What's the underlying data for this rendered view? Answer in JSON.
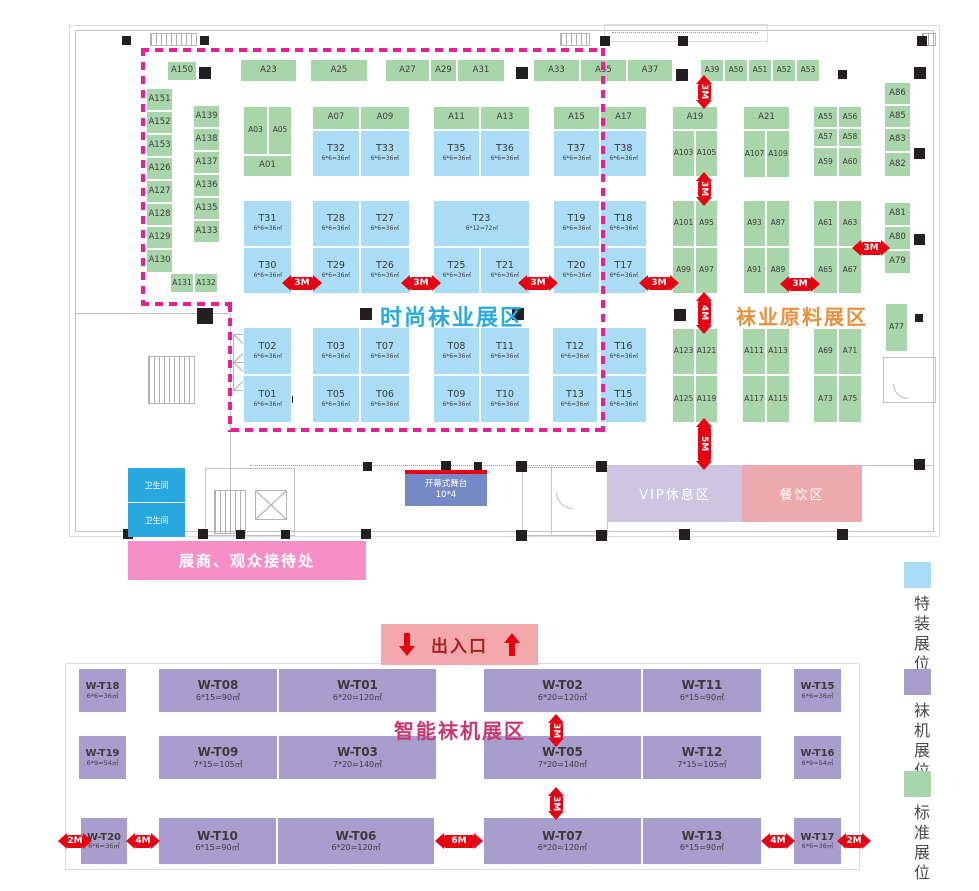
{
  "titles": {
    "fashion": {
      "label": "时尚袜业展区",
      "color": "#29abe2"
    },
    "material": {
      "label": "袜业原料展区",
      "color": "#e8913c"
    },
    "machine": {
      "label": "智能袜机展区",
      "color": "#c9386e"
    }
  },
  "legend": {
    "special": {
      "label": "特装展位",
      "color": "#aadcf5"
    },
    "machine": {
      "label": "袜机展位",
      "color": "#a79ecd"
    },
    "standard": {
      "label": "标准展位",
      "color": "#a8d6aa"
    }
  },
  "facilities": {
    "entrance": {
      "label": "出入口"
    },
    "stage": {
      "label": "开幕式舞台",
      "size": "10*4"
    },
    "vip": {
      "label": "VIP休息区"
    },
    "dining": {
      "label": "餐饮区"
    },
    "reception": {
      "label": "展商、观众接待处"
    },
    "restroom": {
      "label": "卫生间"
    }
  },
  "booths": {
    "standard": [
      [
        "A150",
        167,
        61,
        30,
        20
      ],
      [
        "A151",
        146,
        88,
        27,
        23
      ],
      [
        "A152",
        146,
        111,
        27,
        23
      ],
      [
        "A153",
        146,
        134,
        27,
        23
      ],
      [
        "A126",
        146,
        157,
        27,
        23
      ],
      [
        "A127",
        146,
        180,
        27,
        23
      ],
      [
        "A128",
        146,
        203,
        27,
        23
      ],
      [
        "A129",
        146,
        226,
        27,
        23
      ],
      [
        "A130",
        146,
        249,
        27,
        24
      ],
      [
        "A139",
        193,
        105,
        27,
        23
      ],
      [
        "A138",
        193,
        128,
        27,
        23
      ],
      [
        "A137",
        193,
        151,
        27,
        23
      ],
      [
        "A136",
        193,
        174,
        27,
        23
      ],
      [
        "A135",
        193,
        197,
        27,
        23
      ],
      [
        "A133",
        193,
        220,
        27,
        23
      ],
      [
        "A131",
        170,
        273,
        24,
        20
      ],
      [
        "A132",
        194,
        273,
        24,
        20
      ],
      [
        "A23",
        240,
        59,
        57,
        23
      ],
      [
        "A25",
        310,
        59,
        58,
        23
      ],
      [
        "A27",
        385,
        59,
        45,
        23
      ],
      [
        "A29",
        430,
        59,
        27,
        23
      ],
      [
        "A31",
        457,
        59,
        48,
        23
      ],
      [
        "A33",
        533,
        59,
        47,
        23
      ],
      [
        "A35",
        580,
        59,
        47,
        23
      ],
      [
        "A37",
        627,
        59,
        46,
        23
      ],
      [
        "A39",
        700,
        59,
        24,
        23
      ],
      [
        "A50",
        724,
        59,
        24,
        23
      ],
      [
        "A51",
        748,
        59,
        24,
        23
      ],
      [
        "A52",
        772,
        59,
        24,
        23
      ],
      [
        "A53",
        796,
        59,
        24,
        23
      ],
      [
        "A03",
        243,
        106,
        25,
        49
      ],
      [
        "A05",
        268,
        106,
        24,
        49
      ],
      [
        "A01",
        243,
        155,
        49,
        22
      ],
      [
        "A07",
        312,
        106,
        48,
        24
      ],
      [
        "A09",
        360,
        106,
        50,
        24
      ],
      [
        "A11",
        433,
        106,
        47,
        24
      ],
      [
        "A13",
        480,
        106,
        50,
        24
      ],
      [
        "A15",
        553,
        106,
        47,
        24
      ],
      [
        "A17",
        600,
        106,
        47,
        24
      ],
      [
        "A19",
        672,
        106,
        46,
        24
      ],
      [
        "A21",
        743,
        106,
        47,
        24
      ],
      [
        "A103",
        672,
        130,
        23,
        47
      ],
      [
        "A105",
        695,
        130,
        23,
        47
      ],
      [
        "A107",
        743,
        130,
        23,
        48
      ],
      [
        "A109",
        766,
        130,
        24,
        48
      ],
      [
        "A55",
        813,
        106,
        25,
        22
      ],
      [
        "A56",
        838,
        106,
        24,
        22
      ],
      [
        "A57",
        813,
        128,
        25,
        19
      ],
      [
        "A58",
        838,
        128,
        24,
        19
      ],
      [
        "A59",
        813,
        147,
        25,
        30
      ],
      [
        "A60",
        838,
        147,
        24,
        30
      ],
      [
        "A86",
        884,
        82,
        27,
        23
      ],
      [
        "A85",
        884,
        105,
        27,
        23
      ],
      [
        "A83",
        884,
        128,
        27,
        24
      ],
      [
        "A82",
        884,
        152,
        27,
        25
      ],
      [
        "A101",
        672,
        200,
        23,
        47
      ],
      [
        "A95",
        695,
        200,
        23,
        47
      ],
      [
        "A99",
        672,
        247,
        23,
        47
      ],
      [
        "A97",
        695,
        247,
        23,
        47
      ],
      [
        "A93",
        743,
        200,
        23,
        47
      ],
      [
        "A87",
        766,
        200,
        24,
        47
      ],
      [
        "A91",
        743,
        247,
        23,
        47
      ],
      [
        "A89",
        766,
        247,
        24,
        47
      ],
      [
        "A61",
        813,
        200,
        25,
        47
      ],
      [
        "A63",
        838,
        200,
        24,
        47
      ],
      [
        "A65",
        813,
        247,
        25,
        47
      ],
      [
        "A67",
        838,
        247,
        24,
        47
      ],
      [
        "A81",
        884,
        202,
        27,
        24
      ],
      [
        "A80",
        884,
        226,
        27,
        24
      ],
      [
        "A79",
        884,
        250,
        27,
        24
      ],
      [
        "A123",
        672,
        328,
        23,
        47
      ],
      [
        "A121",
        695,
        328,
        23,
        47
      ],
      [
        "A125",
        672,
        375,
        23,
        48
      ],
      [
        "A119",
        695,
        375,
        23,
        48
      ],
      [
        "A111",
        742,
        328,
        24,
        47
      ],
      [
        "A113",
        766,
        328,
        24,
        47
      ],
      [
        "A117",
        742,
        375,
        24,
        48
      ],
      [
        "A115",
        766,
        375,
        24,
        48
      ],
      [
        "A69",
        813,
        328,
        25,
        47
      ],
      [
        "A71",
        838,
        328,
        24,
        47
      ],
      [
        "A73",
        813,
        375,
        25,
        48
      ],
      [
        "A75",
        838,
        375,
        24,
        48
      ],
      [
        "A77",
        885,
        303,
        23,
        49
      ]
    ],
    "special": [
      [
        "T32",
        312,
        130,
        48,
        47,
        "6*6=36㎡"
      ],
      [
        "T33",
        360,
        130,
        50,
        47,
        "6*6=36㎡"
      ],
      [
        "T35",
        433,
        130,
        47,
        47,
        "6*6=36㎡"
      ],
      [
        "T36",
        480,
        130,
        50,
        47,
        "6*6=36㎡"
      ],
      [
        "T37",
        553,
        130,
        47,
        47,
        "6*6=36㎡"
      ],
      [
        "T38",
        600,
        130,
        47,
        47,
        "6*6=36㎡"
      ],
      [
        "T31",
        243,
        200,
        49,
        47,
        "6*6=36㎡"
      ],
      [
        "T30",
        243,
        247,
        49,
        47,
        "6*6=36㎡"
      ],
      [
        "T28",
        312,
        200,
        48,
        47,
        "6*6=36㎡"
      ],
      [
        "T27",
        360,
        200,
        50,
        47,
        "6*6=36㎡"
      ],
      [
        "T29",
        312,
        247,
        48,
        47,
        "6*6=36㎡"
      ],
      [
        "T26",
        360,
        247,
        50,
        47,
        "6*6=36㎡"
      ],
      [
        "T23",
        433,
        200,
        97,
        47,
        "6*12=72㎡"
      ],
      [
        "T25",
        433,
        247,
        47,
        47,
        "6*6=36㎡"
      ],
      [
        "T21",
        480,
        247,
        50,
        47,
        "6*6=36㎡"
      ],
      [
        "T19",
        553,
        200,
        47,
        47,
        "6*6=36㎡"
      ],
      [
        "T18",
        600,
        200,
        47,
        47,
        "6*6=36㎡"
      ],
      [
        "T20",
        553,
        247,
        47,
        47,
        "6*6=36㎡"
      ],
      [
        "T17",
        600,
        247,
        47,
        47,
        "6*6=36㎡"
      ],
      [
        "T02",
        243,
        327,
        49,
        48,
        "6*6=36㎡"
      ],
      [
        "T01",
        243,
        375,
        49,
        48,
        "6*6=36㎡"
      ],
      [
        "T03",
        312,
        327,
        48,
        48,
        "6*6=36㎡"
      ],
      [
        "T07",
        360,
        327,
        50,
        48,
        "6*6=36㎡"
      ],
      [
        "T05",
        312,
        375,
        48,
        48,
        "6*6=36㎡"
      ],
      [
        "T06",
        360,
        375,
        50,
        48,
        "6*6=36㎡"
      ],
      [
        "T08",
        433,
        327,
        47,
        48,
        "6*6=36㎡"
      ],
      [
        "T11",
        480,
        327,
        50,
        48,
        "6*6=36㎡"
      ],
      [
        "T09",
        433,
        375,
        47,
        48,
        "6*6=36㎡"
      ],
      [
        "T10",
        480,
        375,
        50,
        48,
        "6*6=36㎡"
      ],
      [
        "T12",
        552,
        327,
        46,
        48,
        "6*6=36㎡"
      ],
      [
        "T13",
        552,
        375,
        46,
        48,
        "6*6=36㎡"
      ],
      [
        "T16",
        600,
        327,
        47,
        48,
        "6*6=36㎡"
      ],
      [
        "T15",
        600,
        375,
        47,
        48,
        "6*6=36㎡"
      ]
    ],
    "machine": [
      [
        "W-T18",
        78,
        668,
        49,
        45,
        "6*6=36㎡"
      ],
      [
        "W-T08",
        158,
        668,
        120,
        45,
        "6*15=90㎡"
      ],
      [
        "W-T01",
        278,
        668,
        159,
        45,
        "6*20=120㎡"
      ],
      [
        "W-T02",
        483,
        668,
        159,
        45,
        "6*20=120㎡"
      ],
      [
        "W-T11",
        642,
        668,
        120,
        45,
        "6*15=90㎡"
      ],
      [
        "W-T15",
        793,
        668,
        49,
        45,
        "6*6=36㎡"
      ],
      [
        "W-T19",
        78,
        735,
        49,
        45,
        "6*9=54㎡"
      ],
      [
        "W-T09",
        158,
        735,
        120,
        45,
        "7*15=105㎡"
      ],
      [
        "W-T03",
        278,
        735,
        159,
        45,
        "7*20=140㎡"
      ],
      [
        "W-T05",
        483,
        735,
        159,
        45,
        "7*20=140㎡"
      ],
      [
        "W-T12",
        642,
        735,
        120,
        45,
        "7*15=105㎡"
      ],
      [
        "W-T16",
        793,
        735,
        49,
        45,
        "6*9=54㎡"
      ],
      [
        "W-T20",
        80,
        817,
        48,
        48,
        "6*6=36㎡"
      ],
      [
        "W-T10",
        158,
        817,
        119,
        48,
        "6*15=90㎡"
      ],
      [
        "W-T06",
        277,
        817,
        158,
        48,
        "6*20=120㎡"
      ],
      [
        "W-T07",
        483,
        817,
        159,
        48,
        "6*20=120㎡"
      ],
      [
        "W-T13",
        642,
        817,
        120,
        48,
        "6*15=90㎡"
      ],
      [
        "W-T17",
        793,
        817,
        49,
        48,
        "6*6=36㎡"
      ]
    ]
  },
  "arrows": [
    [
      "3M",
      "h",
      302,
      283,
      40
    ],
    [
      "3M",
      "h",
      421,
      283,
      40
    ],
    [
      "3M",
      "h",
      538,
      283,
      40
    ],
    [
      "3M",
      "h",
      659,
      283,
      40
    ],
    [
      "3M",
      "h",
      800,
      284,
      40
    ],
    [
      "3M",
      "h",
      871,
      248,
      38
    ],
    [
      "3M",
      "v",
      704,
      92,
      34
    ],
    [
      "3M",
      "v",
      704,
      189,
      34
    ],
    [
      "4M",
      "v",
      704,
      313,
      42
    ],
    [
      "5M",
      "v",
      704,
      444,
      52
    ],
    [
      "3M",
      "v",
      556,
      730,
      32
    ],
    [
      "3M",
      "v",
      556,
      803,
      32
    ],
    [
      "2M",
      "h",
      71,
      841,
      26
    ],
    [
      "4M",
      "h",
      142,
      841,
      32
    ],
    [
      "6M",
      "h",
      459,
      841,
      48
    ],
    [
      "4M",
      "h",
      777,
      841,
      32
    ],
    [
      "2M",
      "h",
      850,
      841,
      26
    ]
  ],
  "columns": [
    [
      199,
      67,
      12
    ],
    [
      516,
      67,
      12
    ],
    [
      676,
      69,
      12
    ],
    [
      914,
      67,
      12
    ],
    [
      360,
      308,
      12
    ],
    [
      512,
      308,
      12
    ],
    [
      674,
      309,
      12
    ],
    [
      197,
      308,
      16
    ],
    [
      914,
      148,
      11
    ],
    [
      914,
      234,
      11
    ],
    [
      914,
      459,
      11
    ],
    [
      122,
      36,
      9
    ],
    [
      200,
      36,
      9
    ],
    [
      600,
      36,
      10
    ],
    [
      678,
      36,
      10
    ],
    [
      917,
      36,
      10
    ],
    [
      123,
      529,
      10
    ],
    [
      198,
      529,
      10
    ],
    [
      236,
      530,
      9
    ],
    [
      281,
      530,
      9
    ],
    [
      361,
      529,
      10
    ],
    [
      441,
      461,
      10
    ],
    [
      363,
      462,
      9
    ],
    [
      474,
      462,
      8
    ],
    [
      516,
      461,
      11
    ],
    [
      596,
      461,
      11
    ],
    [
      516,
      530,
      11
    ],
    [
      596,
      530,
      11
    ],
    [
      679,
      529,
      11
    ],
    [
      837,
      529,
      11
    ],
    [
      286,
      396,
      7
    ],
    [
      361,
      395,
      7
    ],
    [
      442,
      394,
      7
    ],
    [
      522,
      395,
      7
    ],
    [
      604,
      395,
      7
    ],
    [
      678,
      399,
      7
    ],
    [
      761,
      400,
      7
    ],
    [
      841,
      402,
      7
    ],
    [
      839,
      152,
      7
    ],
    [
      840,
      232,
      7
    ],
    [
      915,
      314,
      8
    ],
    [
      838,
      70,
      9
    ]
  ]
}
